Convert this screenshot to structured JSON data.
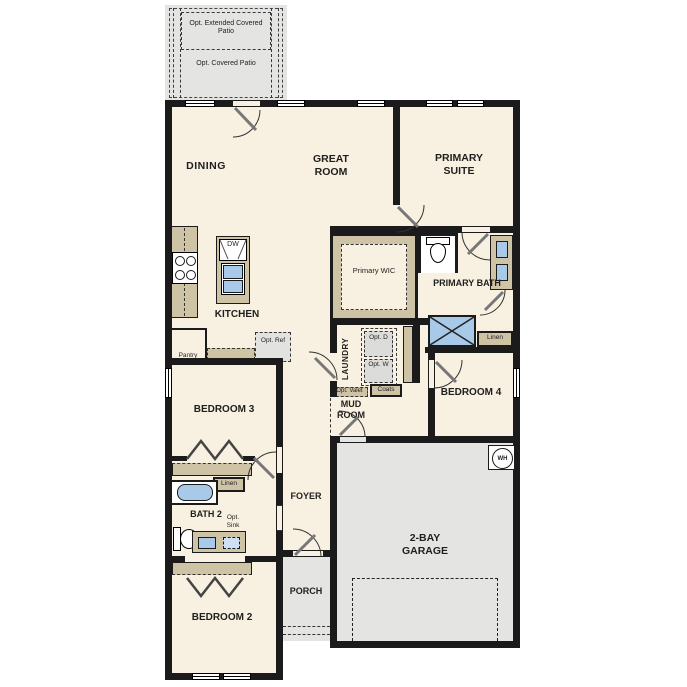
{
  "plan": {
    "patio": {
      "extended": "Opt. Extended Covered Patio",
      "covered": "Opt. Covered Patio"
    },
    "rooms": {
      "dining": "DINING",
      "great_room": "GREAT ROOM",
      "primary_suite": "PRIMARY SUITE",
      "kitchen": "KITCHEN",
      "primary_wic": "Primary WIC",
      "primary_bath": "PRIMARY BATH",
      "laundry": "LAUNDRY",
      "mud_room": "MUD ROOM",
      "bedroom4": "BEDROOM 4",
      "bedroom3": "BEDROOM 3",
      "bath2": "BATH 2",
      "foyer": "FOYER",
      "porch": "PORCH",
      "garage": "2-BAY GARAGE",
      "bedroom2": "BEDROOM 2"
    },
    "fixtures": {
      "dw": "DW",
      "pantry": "Pantry",
      "opt_ref": "Opt. Ref",
      "opt_d": "Opt. D",
      "opt_w": "Opt. W",
      "opt_valet": "Opt. Valet",
      "coats": "Coats",
      "linen_primary": "Linen",
      "linen_hall": "Linen",
      "opt_sink": "Opt. Sink",
      "wh": "WH"
    },
    "colors": {
      "floor": "#f8f0e0",
      "outdoor": "#e4e4e2",
      "cabinet": "#cfc3a6",
      "fixture_blue": "#a9c9e9",
      "wall": "#1b1b1b"
    }
  }
}
